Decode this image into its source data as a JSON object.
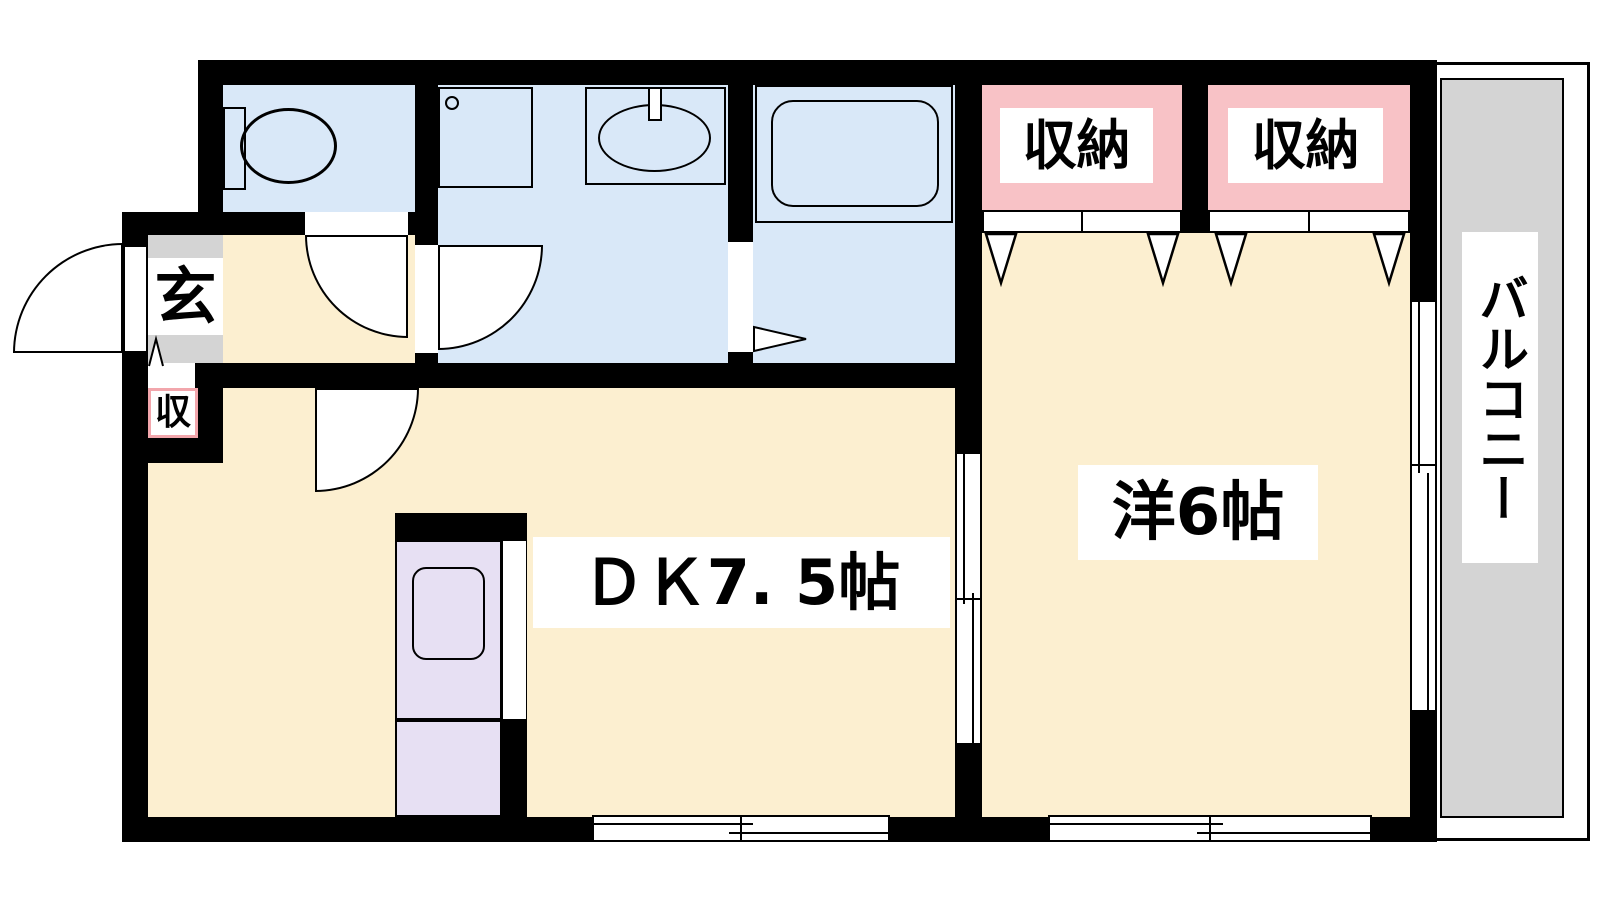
{
  "title": "apartment-floor-plan",
  "labels": {
    "entrance": "玄",
    "shoe_storage": "収",
    "closet_left": "収納",
    "closet_right": "収納",
    "dining_kitchen": "ＤＫ7. 5帖",
    "western_room": "洋6帖",
    "balcony": "バルコニー"
  },
  "icons": [
    "toilet-icon",
    "washing-machine-pan-icon",
    "washbasin-icon",
    "bathtub-icon",
    "kitchen-sink-icon",
    "door-swing-icon",
    "sliding-window-icon",
    "folding-door-icon"
  ],
  "theme": {
    "colors": {
      "floor": "#FCEFD0",
      "wet": "#D9E8F8",
      "closet": "#F8C2C6",
      "kitchen": "#E7E0F3",
      "tile": "#D4D4D4",
      "wall": "#000000",
      "shoe-border": "#F2A6AC"
    }
  }
}
